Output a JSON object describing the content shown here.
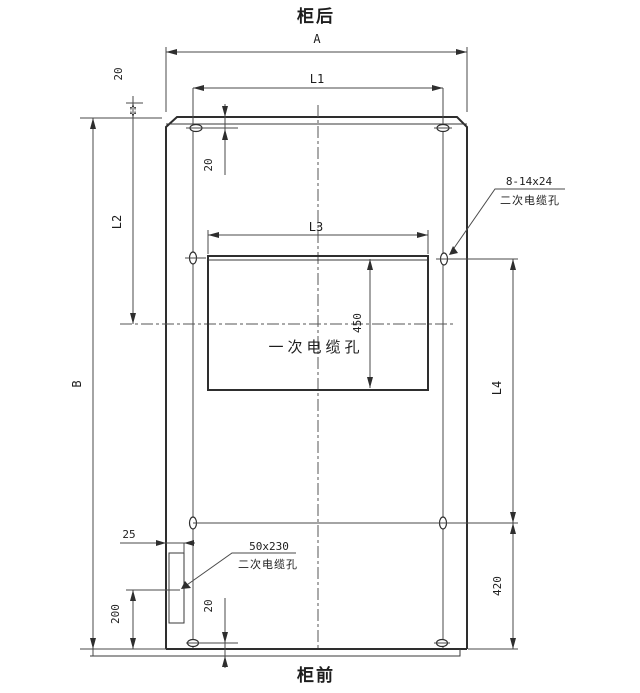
{
  "drawing": {
    "orientation": {
      "top": "柜后",
      "bottom": "柜前"
    },
    "colors": {
      "line": "#3a3a3a",
      "background": "#ffffff"
    },
    "dim_labels": {
      "a": "A",
      "b": "B",
      "l1": "L1",
      "l2": "L2",
      "l3": "L3",
      "l4": "L4"
    },
    "dim_values": {
      "v450": "450",
      "v420": "420",
      "v200": "200",
      "v25": "25",
      "v20": "20"
    },
    "callouts": {
      "primary_cable_hole": "一次电缆孔",
      "secondary_top_size": "8-14x24",
      "secondary_top_name": "二次电缆孔",
      "secondary_bottom_size": "50x230",
      "secondary_bottom_name": "二次电缆孔"
    }
  }
}
